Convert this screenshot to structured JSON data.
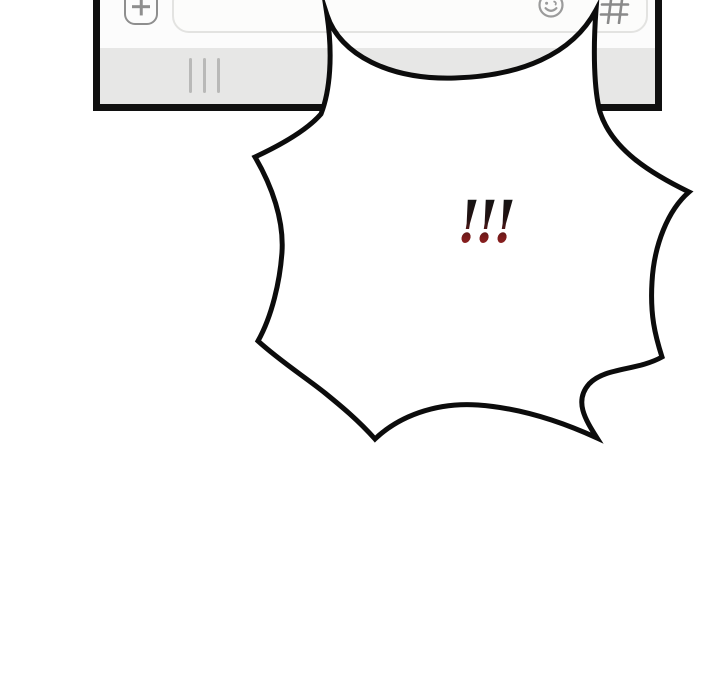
{
  "panel": {
    "background": "#ffffff"
  },
  "phone": {
    "frame_color": "#101010",
    "input_bar": {
      "background": "#fcfcfc",
      "attach_button": {
        "icon": "plus-icon"
      },
      "message_input": {
        "value": ""
      },
      "emoji_button": {
        "icon": "smiley-face-icon"
      },
      "hashtag_button": {
        "icon": "hashtag-icon"
      }
    },
    "keyboard_bar": {
      "background": "#e7e7e6",
      "drag_handle_icon": "three-vertical-lines"
    }
  },
  "bubble": {
    "type": "shock-burst",
    "text": "!!!",
    "fill": "#ffffff",
    "outline_color": "#0c0c0c",
    "text_gradient_top": "#141414",
    "text_gradient_bottom": "#9e2525"
  }
}
